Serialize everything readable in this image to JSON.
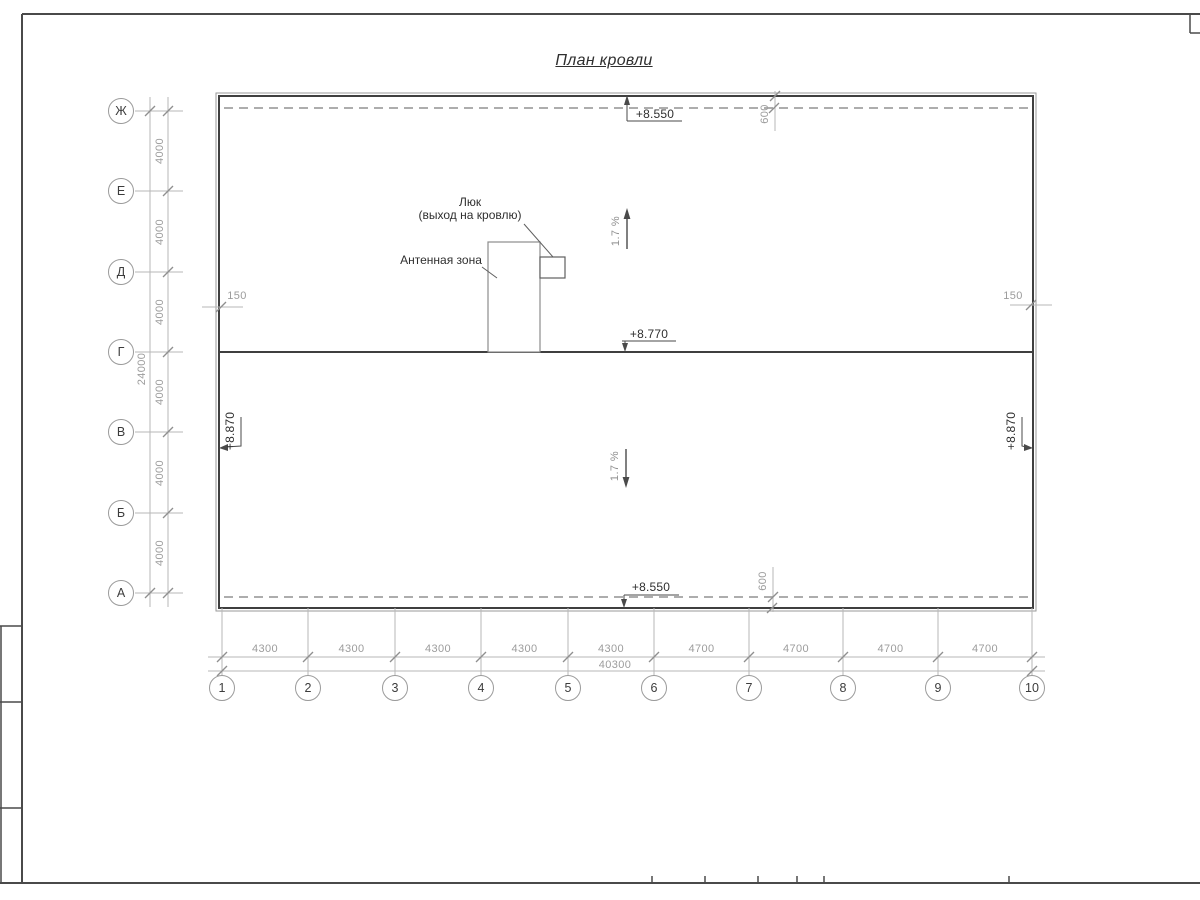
{
  "title": "План кровли",
  "axes": {
    "rows": [
      "Ж",
      "Е",
      "Д",
      "Г",
      "В",
      "Б",
      "А"
    ],
    "cols": [
      "1",
      "2",
      "3",
      "4",
      "5",
      "6",
      "7",
      "8",
      "9",
      "10"
    ]
  },
  "dimensions": {
    "left_segments": [
      "4000",
      "4000",
      "4000",
      "4000",
      "4000",
      "4000"
    ],
    "left_total": "24000",
    "bottom_segments": [
      "4300",
      "4300",
      "4300",
      "4300",
      "4300",
      "4700",
      "4700",
      "4700",
      "4700"
    ],
    "bottom_total": "40300",
    "parapet_left": "150",
    "parapet_right": "150",
    "eaves_top": "600",
    "eaves_bottom": "600"
  },
  "elevations": {
    "top": "+8.550",
    "bottom": "+8.550",
    "ridge": "+8.770",
    "left": "+8.870",
    "right": "+8.870"
  },
  "slopes": {
    "upper": "1.7 %",
    "lower": "1.7 %"
  },
  "labels": {
    "hatch_line1": "Люк",
    "hatch_line2": "(выход на кровлю)",
    "antenna": "Антенная зона"
  },
  "colors": {
    "outline": "#3f3f3f",
    "dim_line": "#b7b7b7",
    "dashed": "#adadad",
    "dim_text": "#9c9c9c",
    "dark_text": "#2f2f2f"
  }
}
